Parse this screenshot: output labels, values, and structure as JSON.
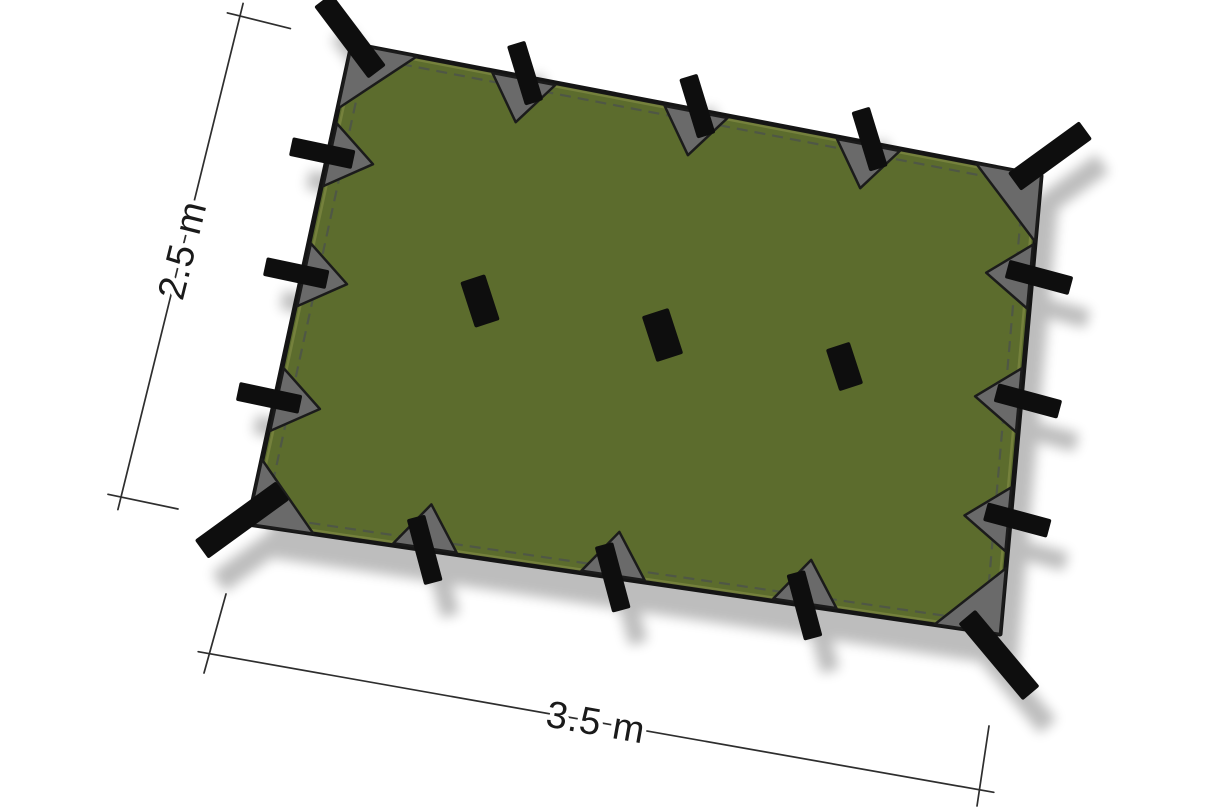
{
  "diagram": {
    "height_label": "2.5 m",
    "width_label": "3.5 m"
  },
  "colors": {
    "background": "#ffffff",
    "tarp": "#5c6c2d",
    "binding": "#79853f",
    "stitch": "#4f5745",
    "outline": "#151515",
    "webbing": "#0e0e0e",
    "reinforcement": "#6a6a6a",
    "reinforcement_outline": "#1b1b1b",
    "dimension": "#2e2e2e",
    "label_text": "#1a1a1a"
  }
}
